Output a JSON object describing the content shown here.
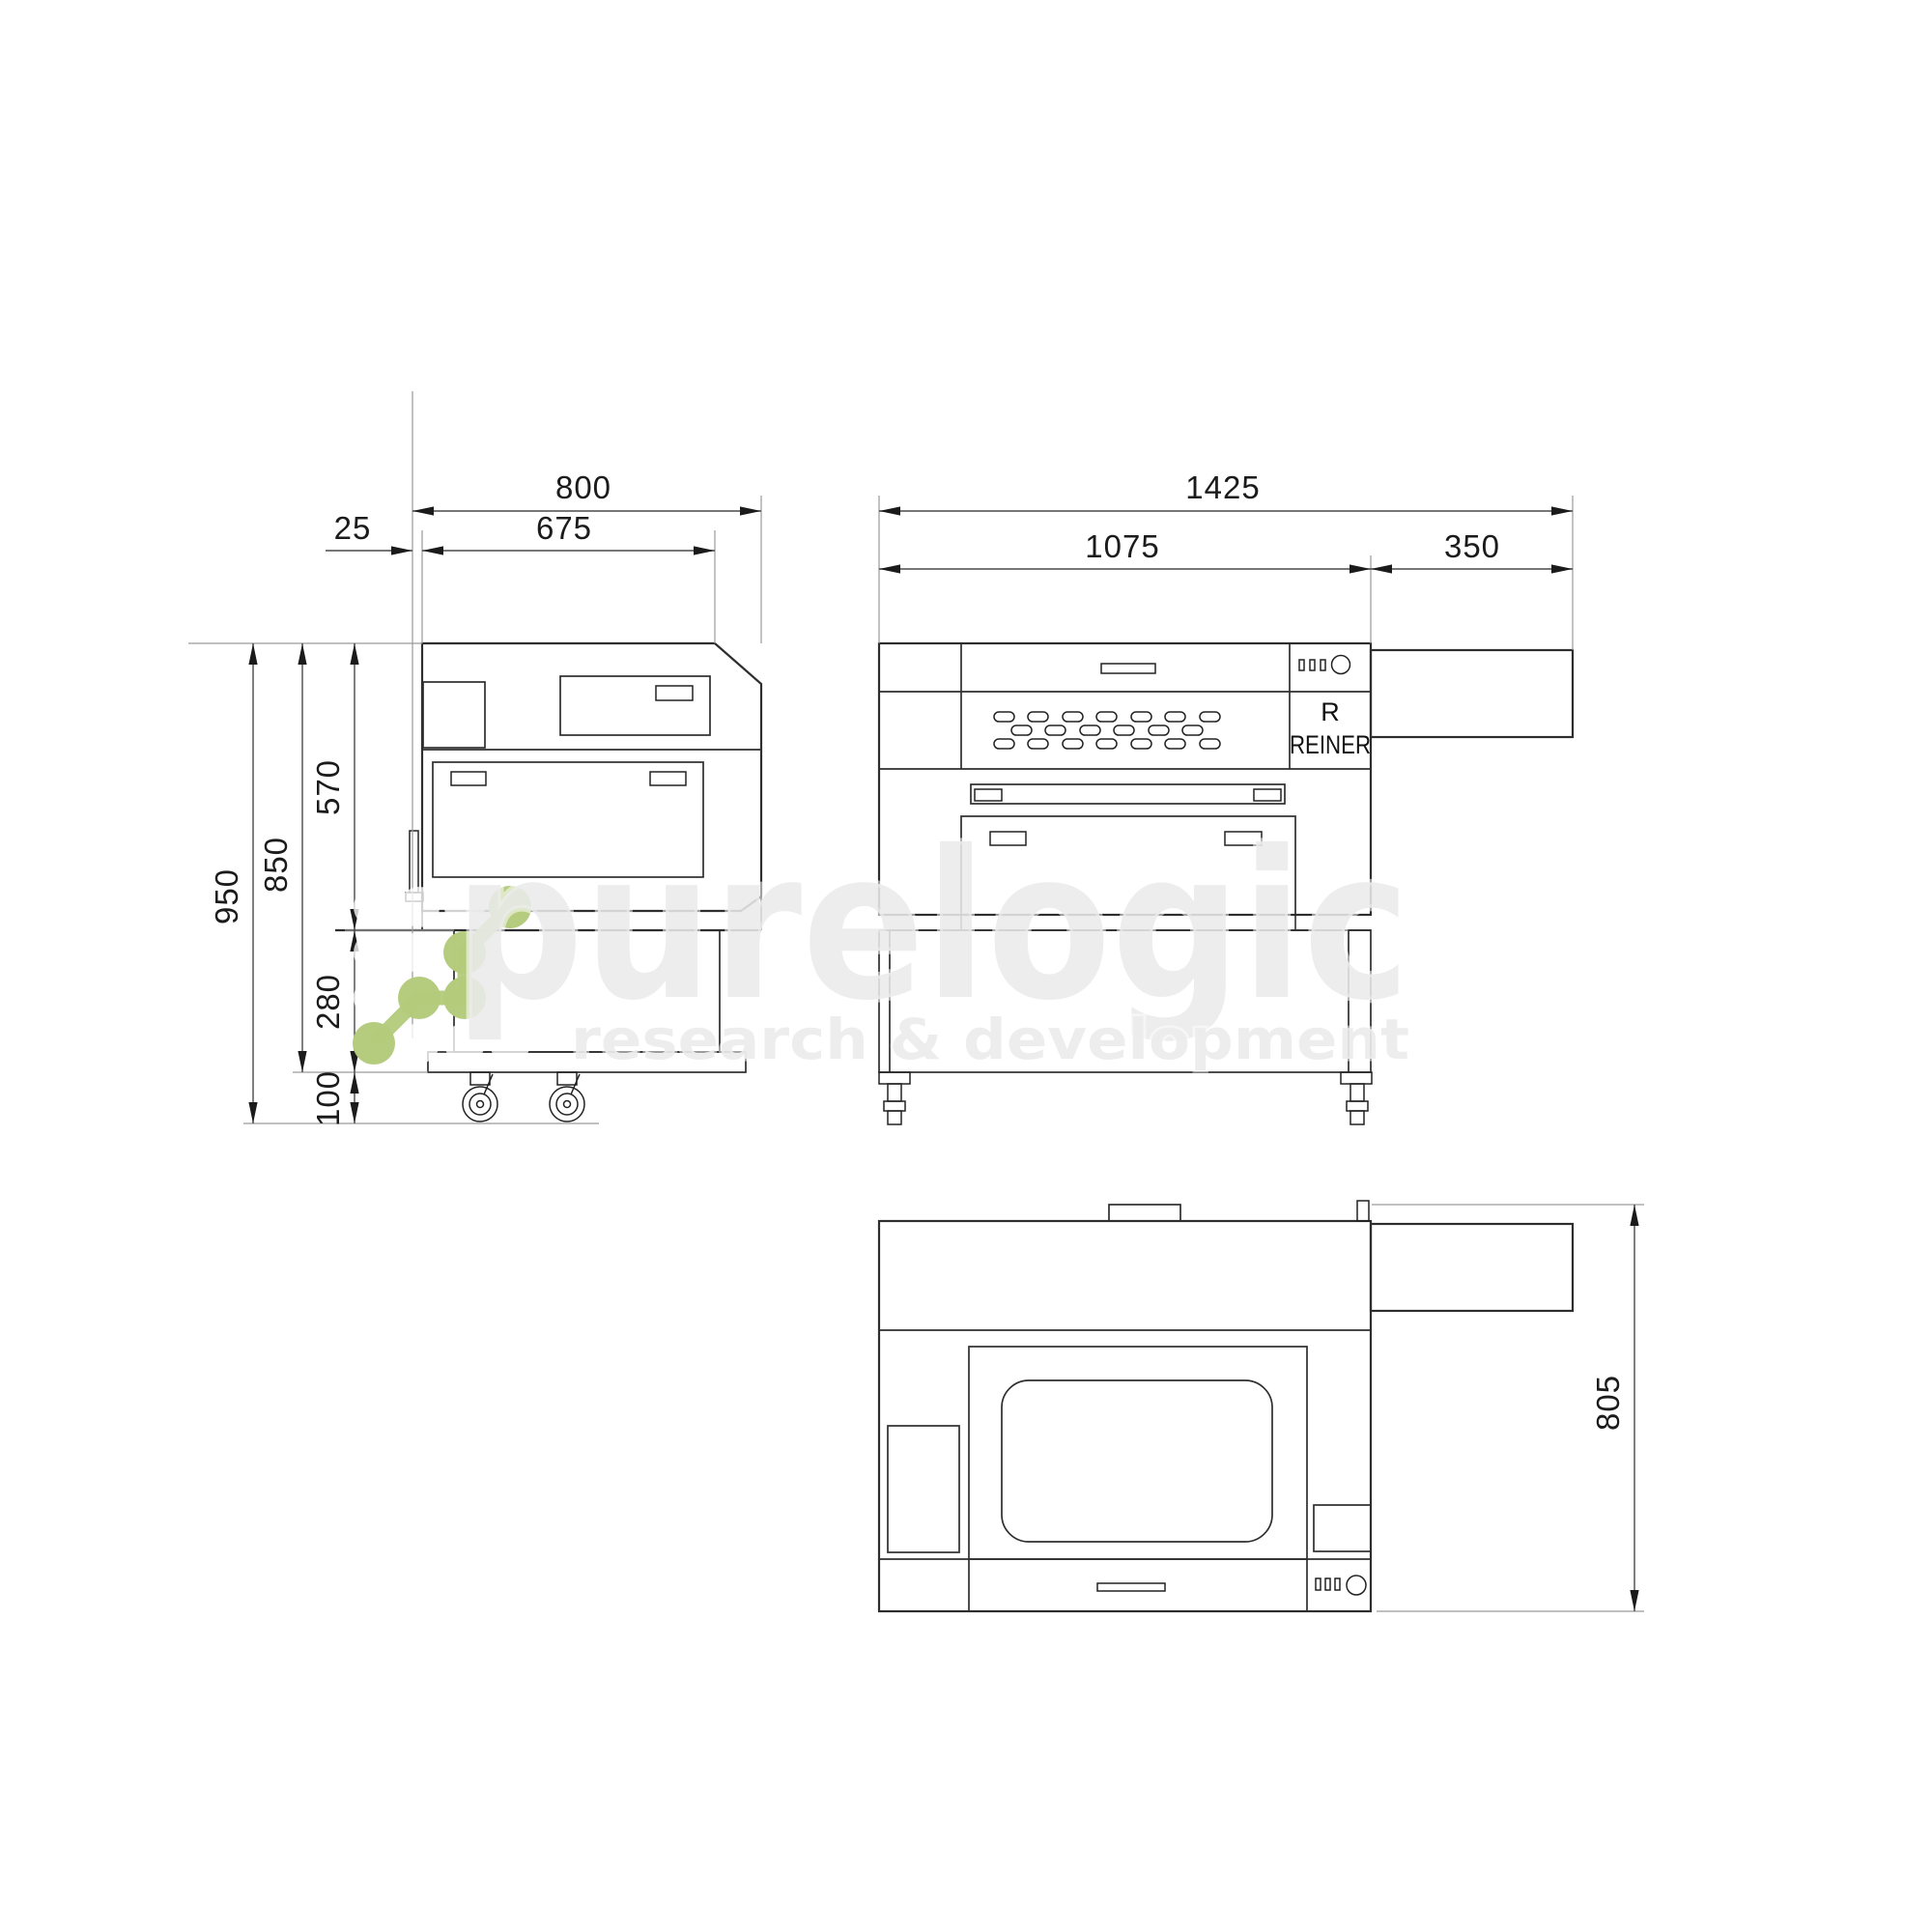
{
  "watermark": {
    "brand": "purelogic",
    "tagline": "research & development",
    "logo_green": "#b3ca7b",
    "text_gray": "#eaeaea"
  },
  "views": {
    "side": {
      "dims": {
        "total_width": "800",
        "top_width": "675",
        "left_offset": "25",
        "body_height": "570",
        "height_without_wheels": "850",
        "total_height": "950",
        "stand_height": "280",
        "wheel_height": "100"
      }
    },
    "front": {
      "dims": {
        "total_width": "1425",
        "body_width": "1075",
        "side_extension": "350"
      },
      "brand_letter": "R",
      "brand": "REINER"
    },
    "plan": {
      "dims": {
        "depth": "805"
      }
    }
  }
}
